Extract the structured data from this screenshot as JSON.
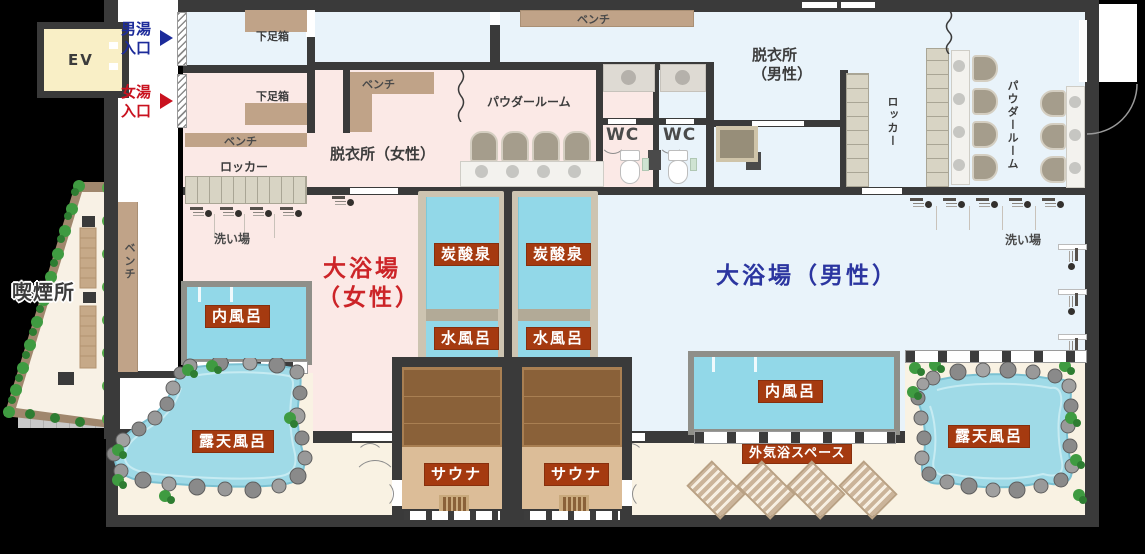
{
  "labels": {
    "ev": "EV",
    "mens_entrance_l1": "男湯",
    "mens_entrance_l2": "入口",
    "womens_entrance_l1": "女湯",
    "womens_entrance_l2": "入口",
    "smoking_area": "喫煙所",
    "shoe_box": "下足箱",
    "bench": "ベンチ",
    "locker": "ロッカー",
    "dressing_women": "脱衣所（女性）",
    "dressing_men_l1": "脱衣所",
    "dressing_men_l2": "（男性）",
    "powder_room": "パウダールーム",
    "wc": "WC",
    "washing_area": "洗い場",
    "bath_women_l1": "大浴場",
    "bath_women_l2": "（女性）",
    "bath_men": "大浴場（男性）",
    "indoor_bath": "内風呂",
    "carbonated_spring": "炭酸泉",
    "cold_bath": "水風呂",
    "sauna": "サウナ",
    "open_air_bath": "露天風呂",
    "outdoor_air_space": "外気浴スペース"
  },
  "colors": {
    "wall": "#3a3a3a",
    "women_floor": "#fbe9e6",
    "men_floor": "#e9f3fa",
    "outdoor_floor": "#f9f2e3",
    "water": "#92d8e8",
    "feature_label_bg": "#a53a10",
    "women_accent": "#cc2428",
    "men_accent": "#2b35a0",
    "bench_tan": "#c0a388",
    "ev_yellow": "#f9efc6",
    "sauna_bench": "#8a6139",
    "sauna_floor": "#dcbd98"
  }
}
